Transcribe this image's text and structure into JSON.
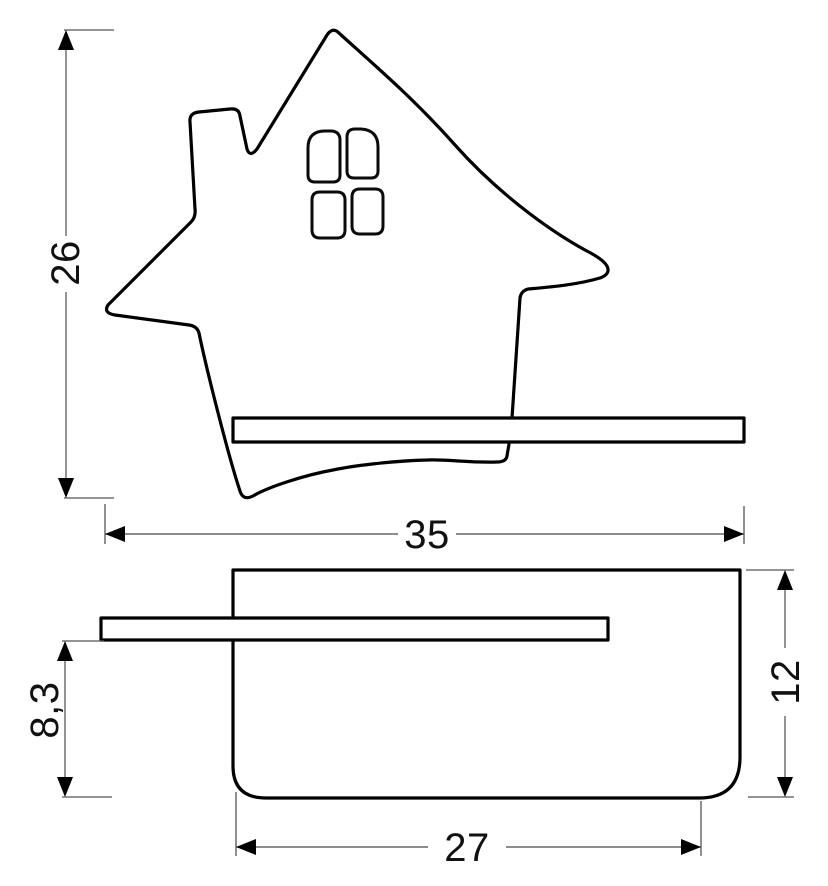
{
  "dimensions": {
    "front_total_height": "26",
    "front_total_width": "35",
    "side_shelf_to_bottom": "8,3",
    "side_total_height": "12",
    "side_bottom_width": "27"
  },
  "colors": {
    "outline": "#000000",
    "dimension_line": "#666666",
    "background": "#ffffff"
  }
}
